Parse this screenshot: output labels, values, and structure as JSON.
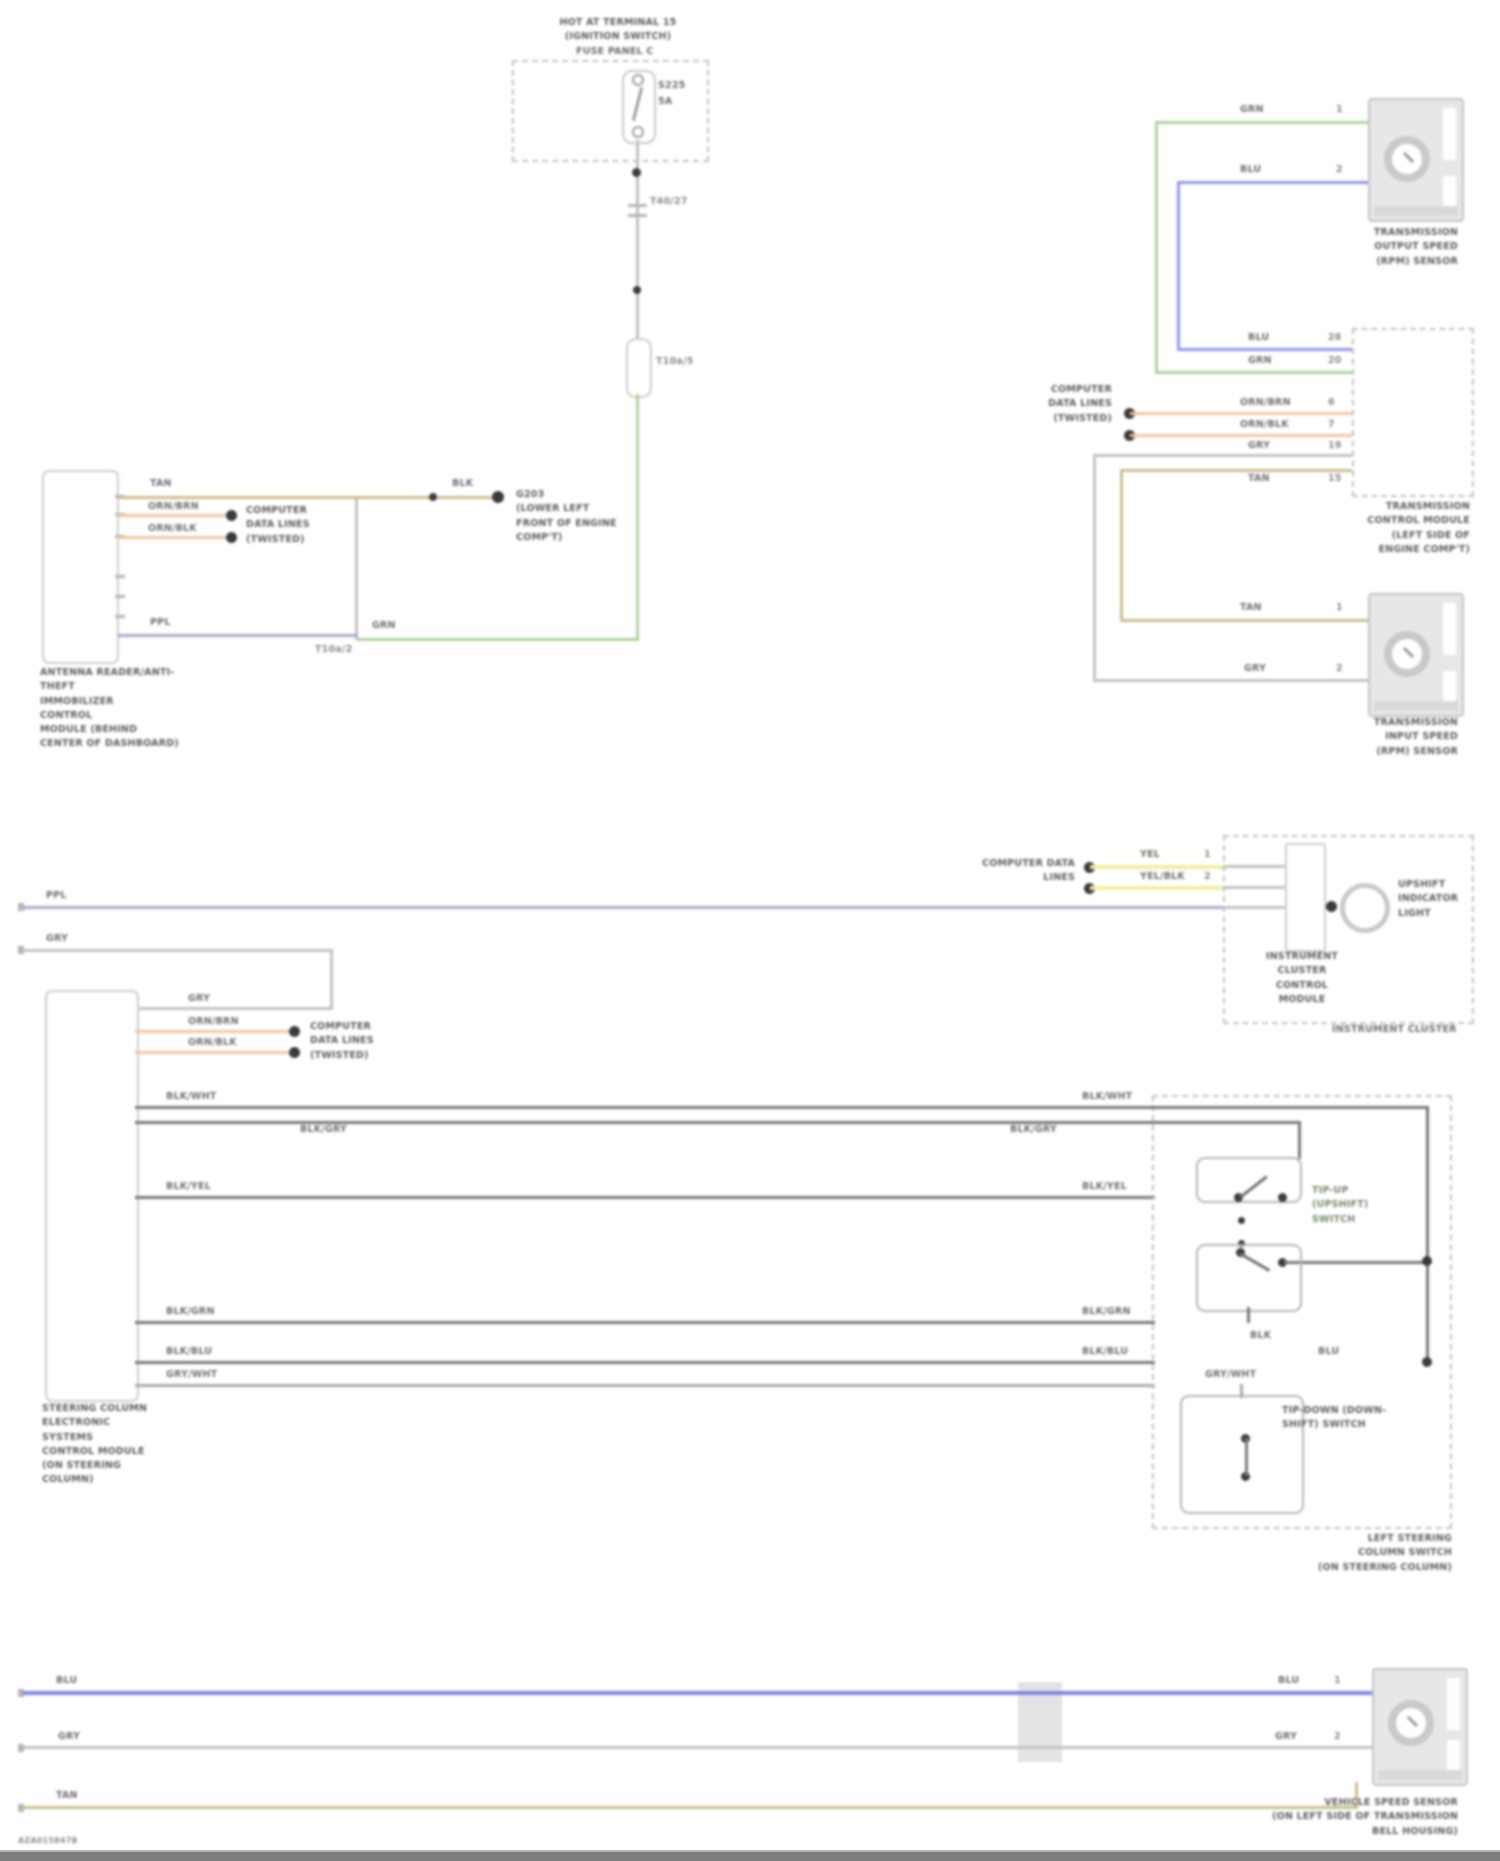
{
  "colors": {
    "green": "#aed3a0",
    "blue": "#9097ea",
    "blue2": "#7d86e8",
    "purple": "#b2a4cb",
    "gray": "#c2c2c2",
    "dark": "#787878",
    "orange": "#efc79d",
    "yellow": "#f0ee9b",
    "tan": "#cbbe8a"
  },
  "fuse": {
    "title": [
      "HOT AT TERMINAL 15",
      "(IGNITION SWITCH)"
    ],
    "panel_label": "FUSE PANEL C",
    "name": "S225",
    "amps": "5A",
    "conn1": "T40/27",
    "conn2": "T10a/5"
  },
  "top_wires": {
    "grn": "GRN",
    "ppl": "PPL",
    "junction": "T10a/2",
    "tan": "TAN",
    "tan2": "BLK"
  },
  "splice": {
    "lines": [
      "G203",
      "(LOWER LEFT",
      "FRONT OF ENGINE",
      "COMP'T)"
    ]
  },
  "antitheft": {
    "orn1": "ORN/BRN",
    "orn2": "ORN/BLK",
    "callout": [
      "COMPUTER",
      "DATA LINES",
      "(TWISTED)"
    ],
    "label": [
      "ANTENNA READER/ANTI-THEFT",
      "IMMOBILIZER",
      "CONTROL",
      "MODULE (BEHIND",
      "CENTER OF DASHBOARD)"
    ]
  },
  "tcm": {
    "label": [
      "TRANSMISSION",
      "CONTROL MODULE",
      "(LEFT SIDE OF",
      "ENGINE COMP'T)"
    ],
    "callout": [
      "COMPUTER",
      "DATA LINES",
      "(TWISTED)"
    ],
    "s1_grn": "GRN",
    "s1_grn_pin": "1",
    "s1_blu": "BLU",
    "s1_blu_pin": "2",
    "r_blu": "BLU",
    "r_blu_pin": "28",
    "r_grn": "GRN",
    "r_grn_pin": "20",
    "r_orn1": "ORN/BRN",
    "r_orn1_pin": "6",
    "r_orn2": "ORN/BLK",
    "r_orn2_pin": "7",
    "r_gry": "GRY",
    "r_gry_pin": "19",
    "r_tan": "TAN",
    "r_tan_pin": "15",
    "s2_tan": "TAN",
    "s2_tan_pin": "1",
    "s2_gry": "GRY",
    "s2_gry_pin": "2"
  },
  "sensors": {
    "output": [
      "TRANSMISSION",
      "OUTPUT SPEED",
      "(RPM) SENSOR"
    ],
    "input": [
      "TRANSMISSION",
      "INPUT SPEED",
      "(RPM) SENSOR"
    ],
    "vss": [
      "VEHICLE SPEED SENSOR",
      "(ON LEFT SIDE OF TRANSMISSION",
      "BELL HOUSING)"
    ]
  },
  "cluster": {
    "callout": [
      "COMPUTER DATA",
      "LINES"
    ],
    "yel1": "YEL",
    "yel2": "YEL/BLK",
    "pin1": "1",
    "pin2": "2",
    "ppl": "PPL",
    "gry": "GRY",
    "gry2": "GRY",
    "inner": [
      "INSTRUMENT",
      "CLUSTER",
      "CONTROL",
      "MODULE"
    ],
    "lamp": [
      "UPSHIFT",
      "INDICATOR",
      "LIGHT"
    ],
    "outer": "INSTRUMENT CLUSTER"
  },
  "steering": {
    "orn1": "ORN/BRN",
    "orn2": "ORN/BLK",
    "callout": [
      "COMPUTER",
      "DATA LINES",
      "(TWISTED)"
    ],
    "label": [
      "STEERING COLUMN",
      "ELECTRONIC",
      "SYSTEMS",
      "CONTROL MODULE",
      "(ON STEERING",
      "COLUMN)"
    ],
    "rows": [
      {
        "left": "BLK/WHT",
        "right": "BLK/WHT"
      },
      {
        "left": "BLK/GRY",
        "right": "BLK/GRY"
      },
      {
        "left": "BLK/YEL",
        "right": "BLK/YEL"
      },
      {
        "left": "BLK/GRN",
        "right": "BLK/GRN"
      },
      {
        "left": "BLK/BLU",
        "right": "BLK/BLU"
      },
      {
        "left": "GRY/WHT",
        "right": "GRY/WHT"
      }
    ]
  },
  "cswitch": {
    "up_label": [
      "TIP-UP",
      "(UPSHIFT)",
      "SWITCH"
    ],
    "down_label": [
      "TIP-DOWN (DOWN-",
      "SHIFT) SWITCH"
    ],
    "inner1": "BLK",
    "inner2": "BLU",
    "label": [
      "LEFT STEERING",
      "COLUMN SWITCH",
      "(ON STEERING COLUMN)"
    ]
  },
  "bottom": {
    "blu_l": "BLU",
    "blu_r": "BLU",
    "pin1": "1",
    "gry_l": "GRY",
    "gry_r": "GRY",
    "pin2": "2",
    "tan_l": "TAN"
  },
  "page": {
    "id": "AZA015847B"
  }
}
